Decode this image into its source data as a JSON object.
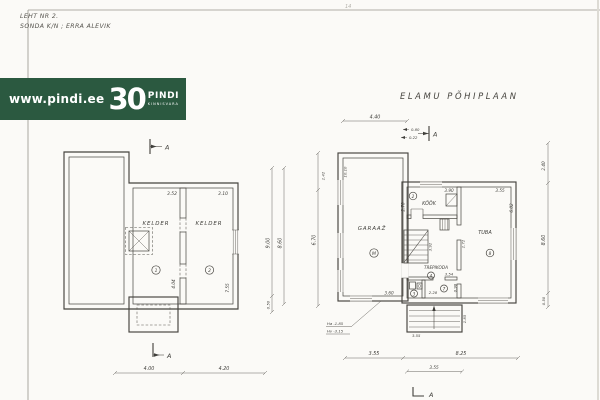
{
  "sheet": {
    "note1": "LEHT NR 2.",
    "note2": "SONDA K/N ; ERRA ALEVIK",
    "top_mark": "14"
  },
  "banner": {
    "url": "www.pindi.ee",
    "big": "30",
    "brand": "PINDI",
    "brand_sub": "KINNISVARA",
    "bg": "#2b5940",
    "fg": "#ffffff"
  },
  "title": "ELAMU PÕHIPLAAN",
  "section": {
    "label": "A"
  },
  "colors": {
    "ink": "#3f3e3a",
    "paper": "#fbfaf7",
    "banner_green": "#2b5940"
  },
  "basement": {
    "room1": {
      "label": "KELDER",
      "num": "1",
      "width": "3.52",
      "depth": "4.04"
    },
    "room2": {
      "label": "KELDER",
      "num": "2",
      "width": "3.10"
    },
    "right_wall_dim": "7.55",
    "bottom": {
      "seg1": "4.00",
      "seg2": "4.20"
    },
    "vert": {
      "total": "9.00",
      "inner": "8.60",
      "offset": "0.50"
    }
  },
  "mainplan": {
    "top": {
      "width": "4.40",
      "d1": "0.80",
      "d2": "0.22"
    },
    "left_vert": {
      "total": "6.70",
      "top": "1.42"
    },
    "right_vert": {
      "top": "2.40",
      "mid": "8.60",
      "bot": "0.50"
    },
    "garage": {
      "label": "GARAAŽ",
      "num": "M",
      "side_note": "10.10",
      "bottom_dim": "3.60"
    },
    "kitchen": {
      "label": "KÖÖK",
      "num": "2",
      "width": "3.90",
      "depth": "2.70"
    },
    "tuba": {
      "label": "TUBA",
      "num": "8",
      "width": "3.55",
      "depth": "6.02",
      "side": "1.72"
    },
    "trepikoda": {
      "label": "TREPIKODA",
      "num": "A",
      "dim": "3.92"
    },
    "hall": {
      "num": "7",
      "w1": "2.28",
      "w2": "3.54",
      "d1": "0.98"
    },
    "wc": {
      "num": "3"
    },
    "stairs": {
      "front": "3.55",
      "depth": "1.85"
    },
    "bottom": {
      "seg1": "3.55",
      "seg2": "8.25",
      "stair": "3.55"
    },
    "levels": {
      "l1": "Ha -1.85",
      "l2": "Hv -3.15"
    }
  }
}
